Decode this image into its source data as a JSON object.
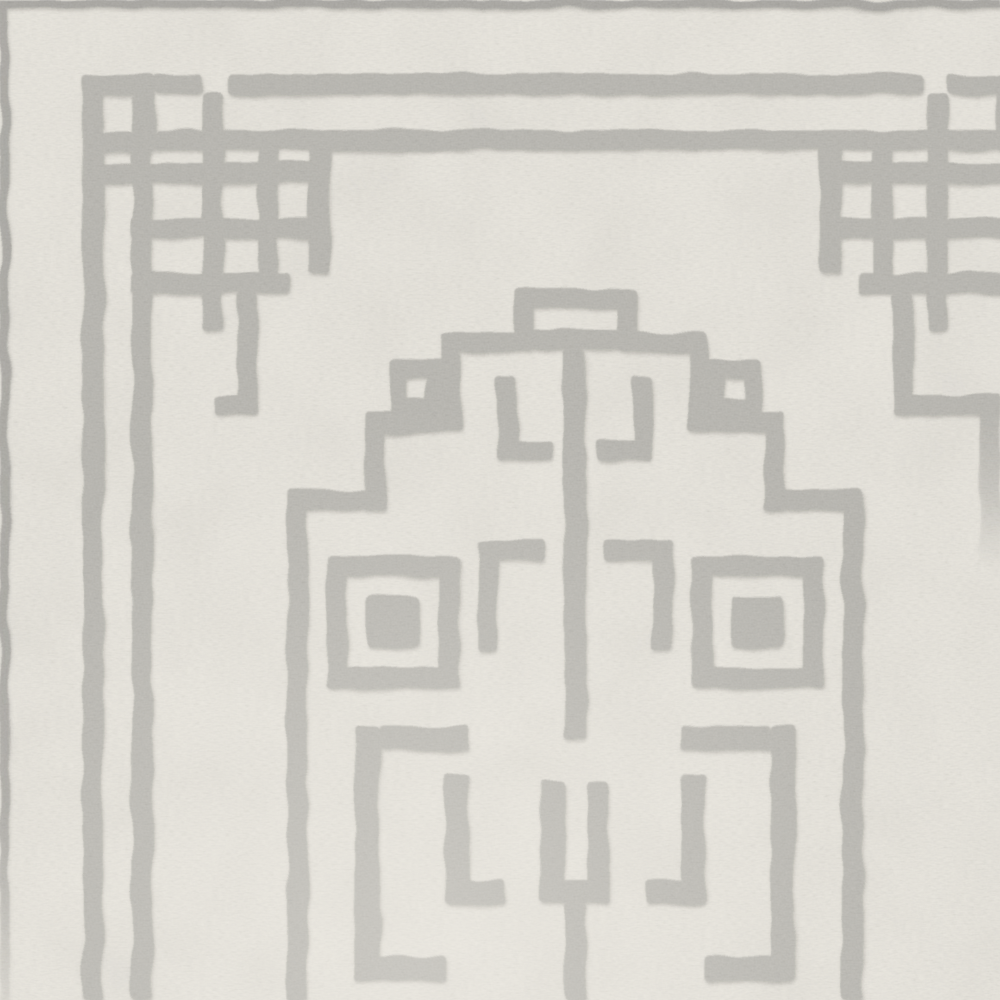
{
  "scene": {
    "subject": "close-up photograph of a hand-tufted wool area rug",
    "pattern": "grey Greek-key fret: double-line border with interlaced square corner knots (top-left and top-right) and a large stepped meander medallion in the center extending past the bottom edge",
    "texture": "looped wool pile with visible stitch grain"
  },
  "colors": {
    "field": "#e8e5dd",
    "field_light": "#f1eee7",
    "pattern_grey": "#b7b5af",
    "edge_grey": "#a7a5a0",
    "shadow_grey": "#93918b"
  }
}
